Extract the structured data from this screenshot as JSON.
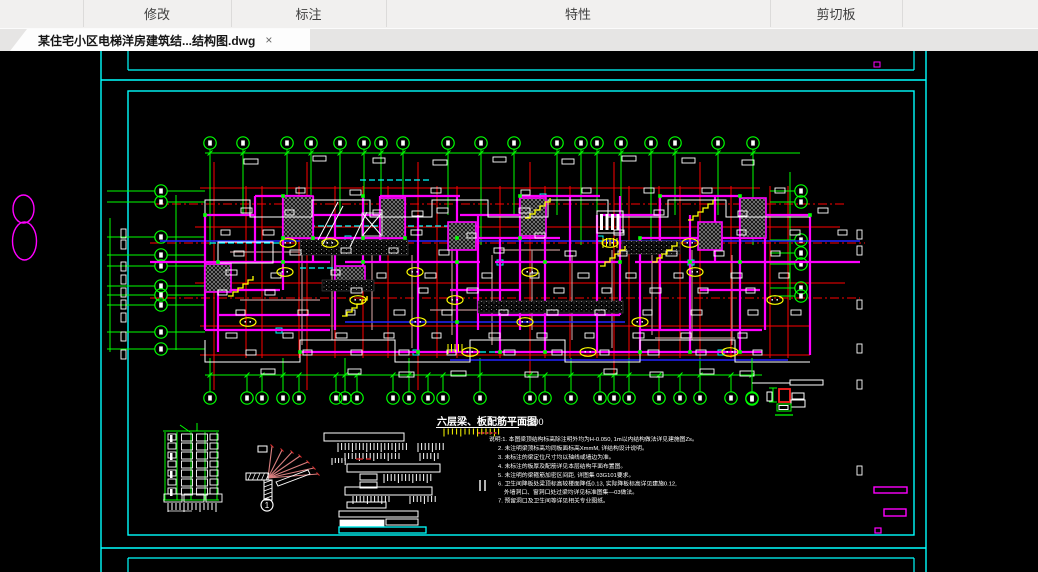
{
  "toolbar": {
    "sections": [
      {
        "label": ""
      },
      {
        "label": "修改"
      },
      {
        "label": "标注"
      },
      {
        "label": "特性"
      },
      {
        "label": "剪切板"
      },
      {
        "label": ""
      }
    ]
  },
  "file_tab": {
    "title": "某住宅小区电梯洋房建筑结...结构图.dwg",
    "close": "×"
  },
  "drawing": {
    "title": "六层梁、板配筋平面图",
    "scale": "1:100",
    "callout_number": "1",
    "notes": [
      "说明:1. 本图梁顶结构标高除注明外均为H-0.050, 1m以内结构做法详见建施图Zs。",
      "2. 未注明梁顶标高均同板面标高XmmM, 详结构设计说明。",
      "3. 未标注的梁定位尺寸均以轴线或墙边为准。",
      "4. 未标注的板厚及配筋详见本层结构平面布置图。",
      "5. 未注明的梁箍筋加密区间距, 详图集  03G101要求。",
      "6. 卫生间降板处梁顶标高较楼面降低0.13, 实际降板标高详见建施0.12,",
      "外墙洞口、窗洞口处过梁均详见标准图集—03做法。",
      "7. 预留洞口及卫生间等详见相关专业图纸。"
    ]
  },
  "colors": {
    "axis_green": "#00ff00",
    "grid_red": "#ff0000",
    "wall_magenta": "#ff00ff",
    "border_cyan": "#00ffff",
    "detail_yellow": "#ffff00",
    "beam_brown": "#bc8f8f",
    "slab_blue": "#2424ff",
    "fan_salmon": "#d98080"
  }
}
